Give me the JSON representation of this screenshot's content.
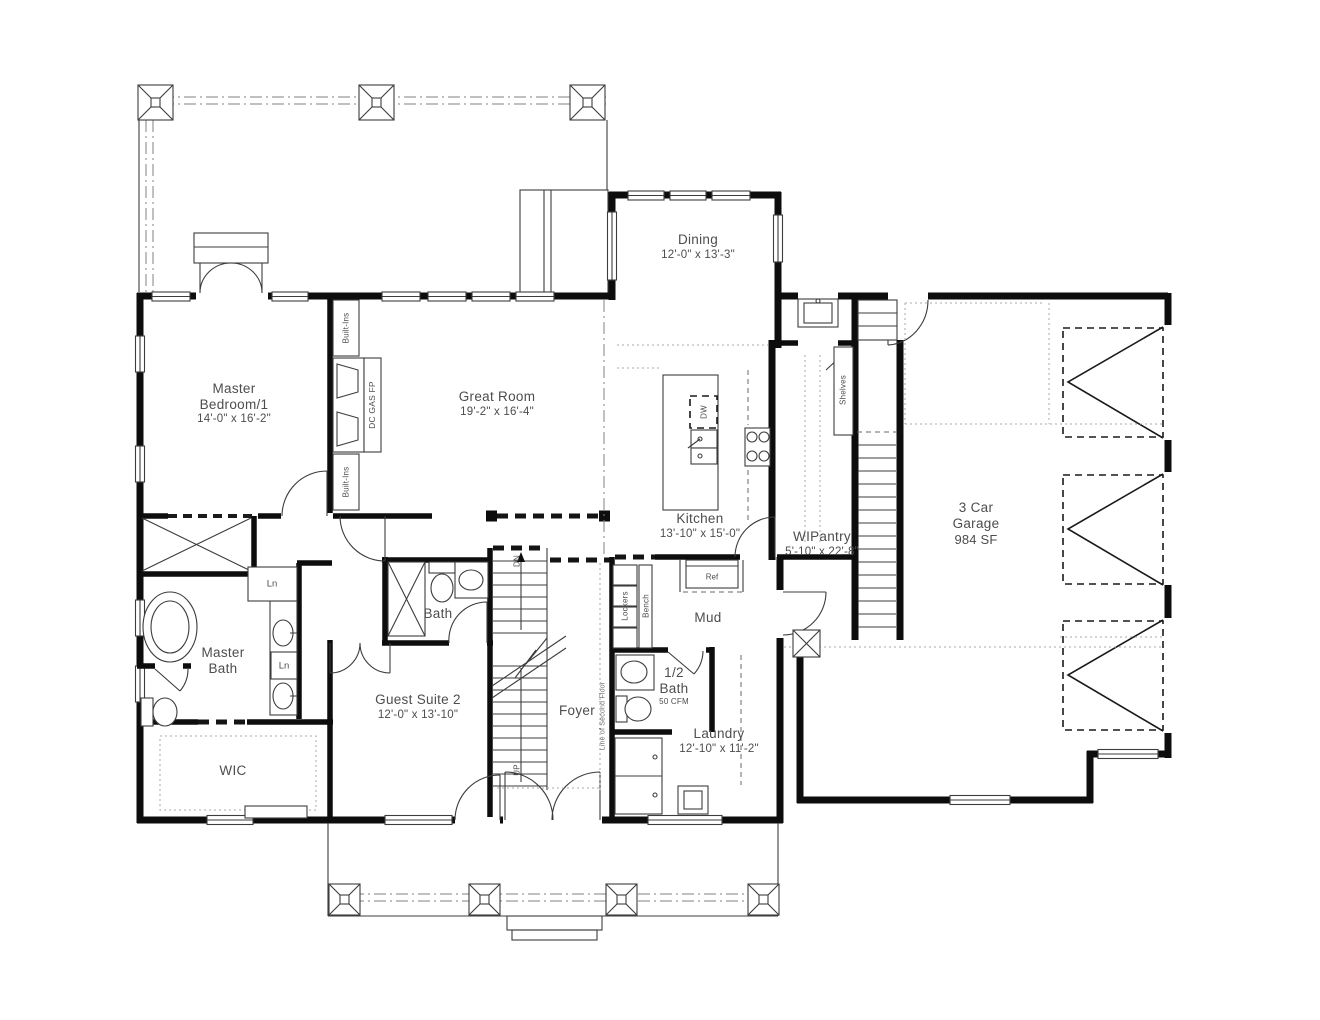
{
  "rooms": {
    "master_bedroom": {
      "name": "Master Bedroom/1",
      "dims": "14'-0\" x 16'-2\""
    },
    "great_room": {
      "name": "Great Room",
      "dims": "19'-2\" x 16'-4\""
    },
    "dining": {
      "name": "Dining",
      "dims": "12'-0\" x 13'-3\""
    },
    "kitchen": {
      "name": "Kitchen",
      "dims": "13'-10\" x 15'-0\""
    },
    "wipantry": {
      "name": "WIPantry",
      "dims": "5'-10\" x 22'-8\""
    },
    "garage": {
      "name": "3 Car Garage",
      "dims": "984 SF"
    },
    "master_bath": {
      "name": "Master Bath"
    },
    "wic": {
      "name": "WIC"
    },
    "guest_suite": {
      "name": "Guest Suite 2",
      "dims": "12'-0\" x 13'-10\""
    },
    "bath": {
      "name": "Bath"
    },
    "foyer": {
      "name": "Foyer"
    },
    "mud": {
      "name": "Mud"
    },
    "half_bath": {
      "name": "1/2 Bath",
      "note": "50 CFM"
    },
    "laundry": {
      "name": "Laundry",
      "dims": "12'-10\" x 11'-2\""
    }
  },
  "annotations": {
    "built_ins_upper": "Built-Ins",
    "built_ins_lower": "Built-Ins",
    "fireplace": "DC GAS FP",
    "shelves": "Shelves",
    "dishwasher": "DW",
    "refrigerator": "Ref",
    "lockers": "Lockers",
    "bench": "Bench",
    "linen_hall": "Ln",
    "linen_vanity": "Ln",
    "stair_down": "DN",
    "stair_up": "UP",
    "second_floor": "Line of Second Floor"
  },
  "colors": {
    "background": "#ffffff",
    "wall": "#0d0d0d",
    "thin_line": "#3c3c3c",
    "label": "#4d4d4d",
    "light_line": "#a8a8a8"
  }
}
